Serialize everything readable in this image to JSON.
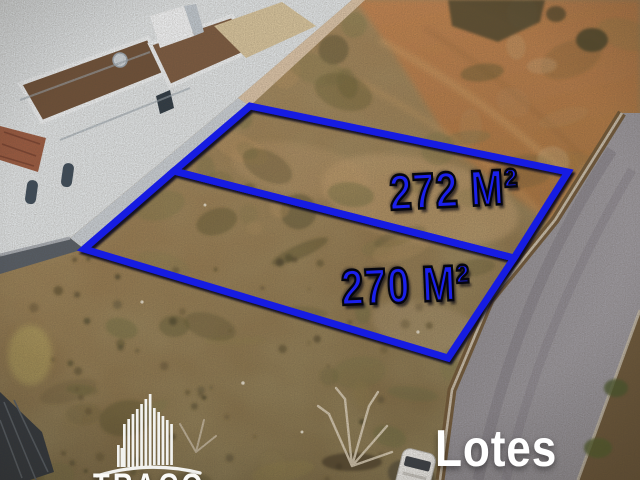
{
  "photo": {
    "description_caption": "Lotes",
    "brand": {
      "name": "TRAÇO",
      "icon": "building-skyline-icon",
      "color": "#fafaf7"
    },
    "lots": [
      {
        "area_label": "272 M²"
      },
      {
        "area_label": "270 M²"
      }
    ],
    "colors": {
      "outline_blue": "#171ae2",
      "label_blue": "#1b20ec",
      "label_outline_black": "#06060e",
      "caption_white": "#ffffff"
    }
  }
}
